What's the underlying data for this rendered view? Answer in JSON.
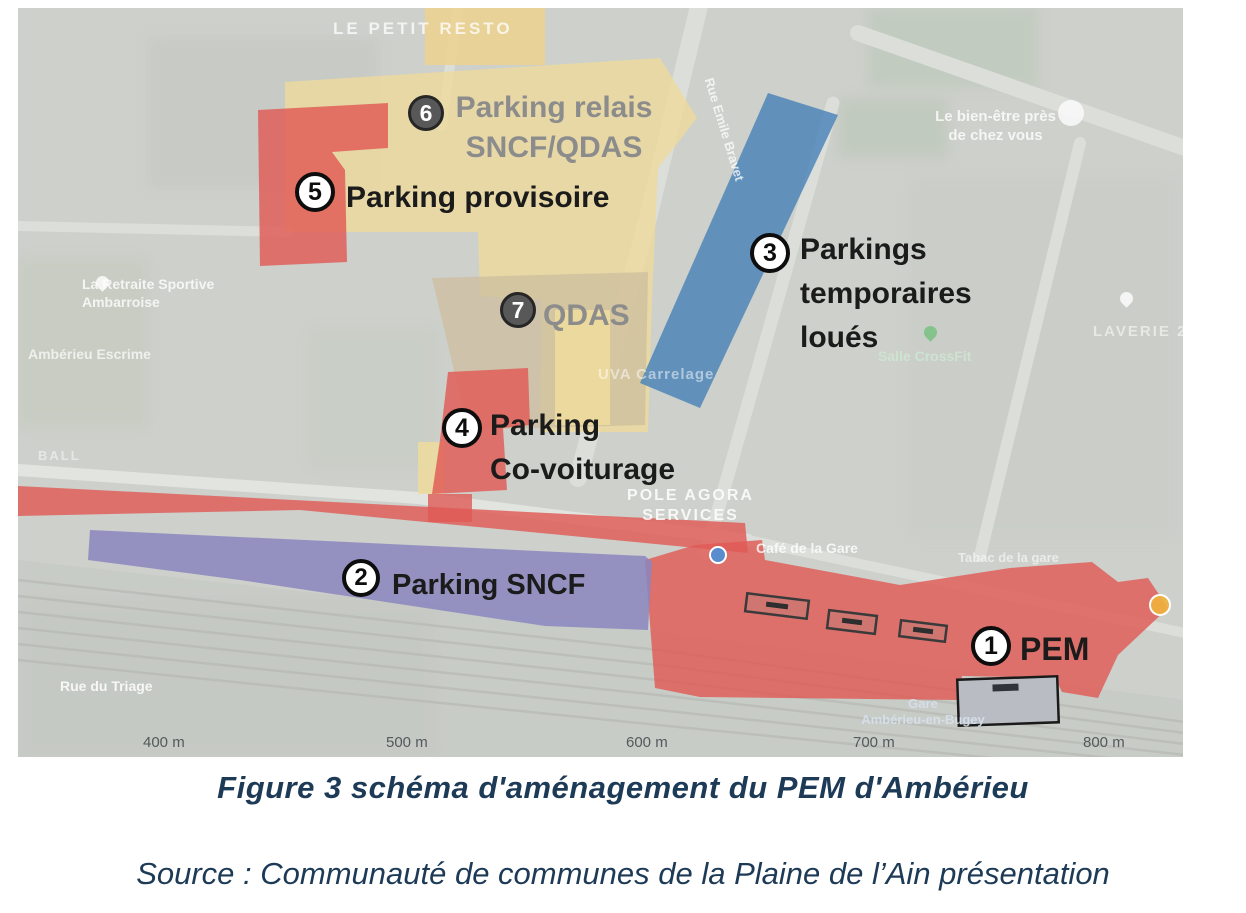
{
  "figure": {
    "caption": "Figure 3 schéma d'aménagement du PEM d'Ambérieu",
    "source": "Source : Communauté de communes de la Plaine de l’Ain présentation"
  },
  "map": {
    "annotations": [
      {
        "num": "1",
        "lines": [
          "PEM"
        ]
      },
      {
        "num": "2",
        "lines": [
          "Parking SNCF"
        ]
      },
      {
        "num": "3",
        "lines": [
          "Parkings",
          "temporaires",
          "loués"
        ]
      },
      {
        "num": "4",
        "lines": [
          "Parking",
          "Co-voiturage"
        ]
      },
      {
        "num": "5",
        "lines": [
          "Parking provisoire"
        ]
      },
      {
        "num": "6",
        "lines": [
          "Parking relais",
          "SNCF/QDAS"
        ]
      },
      {
        "num": "7",
        "lines": [
          "QDAS"
        ]
      }
    ],
    "scale": [
      "400 m",
      "500 m",
      "600 m",
      "700 m",
      "800 m"
    ],
    "bg": {
      "resto": "LE PETIT RESTO",
      "bienetre1": "Le bien-être près",
      "bienetre2": "de chez vous",
      "retraite1": "La Retraite Sportive",
      "retraite2": "Ambarroise",
      "escrime": "Ambérieu Escrime",
      "laverie": "LAVERIE 2",
      "crossfit": "Salle CrossFit",
      "agora1": "POLE AGORA",
      "agora2": "SERVICES",
      "cafe": "Café de la Gare",
      "tabac": "Tabac de la gare",
      "rue_triage": "Rue du Triage",
      "rue_emile": "Rue Emile Bravet",
      "carrelage": "UVA Carrelage",
      "ball": "BALL",
      "gare1": "Gare",
      "gare2": "Ambérieu-en-Bugey"
    }
  },
  "colors": {
    "zone_red": "#e05a55",
    "zone_yellow": "#eeda9c",
    "zone_yellow_dark": "#ecd28e",
    "zone_tan": "#cdbf9f",
    "zone_blue": "#4d86b8",
    "zone_purple": "#8a86c0",
    "station_gray": "#b9bdc3",
    "poi_blue": "#4a90d9",
    "poi_yellow": "#f0b13e",
    "caption_navy": "#1d3a56"
  }
}
